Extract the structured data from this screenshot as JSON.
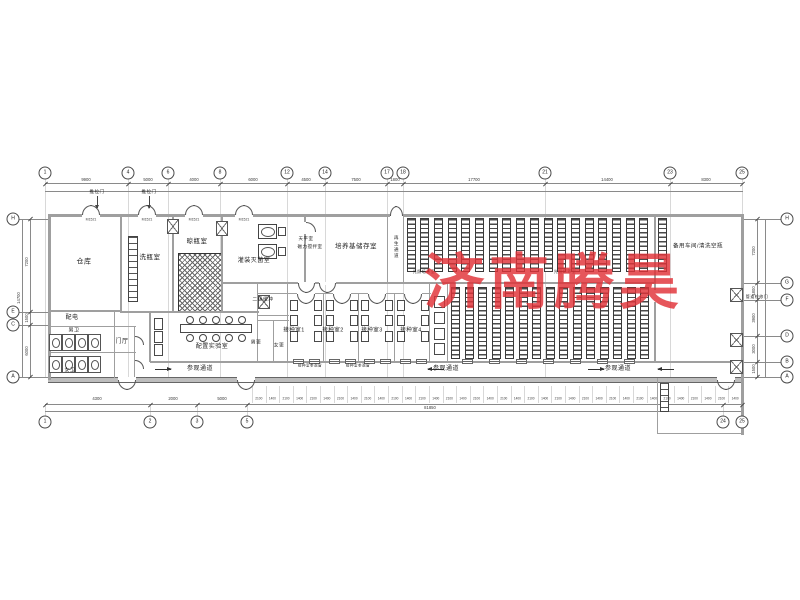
{
  "watermark": {
    "text": "济南腾昊",
    "color": "#e13238"
  },
  "plan": {
    "room_labels": [
      {
        "id": "warehouse",
        "label": "仓库",
        "x": 84,
        "y": 262,
        "fs": 7
      },
      {
        "id": "bottle-washing-room",
        "label": "洗瓶室",
        "x": 150,
        "y": 258,
        "fs": 6.5
      },
      {
        "id": "bottle-drying-room",
        "label": "晾瓶室",
        "x": 197,
        "y": 242,
        "fs": 6.5
      },
      {
        "id": "filling-sterilizing-room",
        "label": "灌装灭菌室",
        "x": 254,
        "y": 261,
        "fs": 6
      },
      {
        "id": "medium-storage-room",
        "label": "培养基储存室",
        "x": 356,
        "y": 247,
        "fs": 6.5
      },
      {
        "id": "regeneration-corridor",
        "label": "再生通道",
        "x": 396,
        "y": 247,
        "fs": 4.5,
        "vertical": true
      },
      {
        "id": "spare-workshop",
        "label": "备用车间/清洗空瓶",
        "x": 698,
        "y": 247,
        "fs": 5.5
      },
      {
        "id": "power-distribution",
        "label": "配电",
        "x": 72,
        "y": 318,
        "fs": 6
      },
      {
        "id": "toilet-male",
        "label": "男卫",
        "x": 74,
        "y": 331,
        "fs": 5
      },
      {
        "id": "toilet-female",
        "label": "女卫",
        "x": 70,
        "y": 371,
        "fs": 5
      },
      {
        "id": "entrance-hall",
        "label": "门厅",
        "x": 122,
        "y": 342,
        "fs": 6
      },
      {
        "id": "prep-laboratory",
        "label": "配置实验室",
        "x": 212,
        "y": 347,
        "fs": 6
      },
      {
        "id": "secondary-buffer",
        "label": "二级缓冲",
        "x": 263,
        "y": 301,
        "fs": 4.8
      },
      {
        "id": "changing-male",
        "label": "男更",
        "x": 256,
        "y": 344,
        "fs": 4.8
      },
      {
        "id": "changing-female",
        "label": "女更",
        "x": 279,
        "y": 347,
        "fs": 4.8
      },
      {
        "id": "inoculation-room-1",
        "label": "接种室1",
        "x": 294,
        "y": 331,
        "fs": 5.5
      },
      {
        "id": "inoculation-room-2",
        "label": "接种室2",
        "x": 333,
        "y": 331,
        "fs": 5.5
      },
      {
        "id": "inoculation-room-3",
        "label": "接种室3",
        "x": 372,
        "y": 331,
        "fs": 5.5
      },
      {
        "id": "inoculation-room-4",
        "label": "接种室4",
        "x": 411,
        "y": 331,
        "fs": 5.5
      },
      {
        "id": "visit-corridor-1",
        "label": "参观通道",
        "x": 200,
        "y": 369,
        "fs": 6
      },
      {
        "id": "visit-corridor-2",
        "label": "参观通道",
        "x": 446,
        "y": 369,
        "fs": 6
      },
      {
        "id": "visit-corridor-3",
        "label": "参观通道",
        "x": 618,
        "y": 369,
        "fs": 6
      },
      {
        "id": "light-culture-room-1",
        "label": "光照培养室",
        "x": 424,
        "y": 272,
        "fs": 4
      },
      {
        "id": "light-culture-room-2",
        "label": "光照培养室",
        "x": 565,
        "y": 272,
        "fs": 4
      },
      {
        "id": "sliding-door-note-1",
        "label": "推拉门",
        "x": 97,
        "y": 192,
        "fs": 4.5
      },
      {
        "id": "sliding-door-note-2",
        "label": "推拉门",
        "x": 149,
        "y": 192,
        "fs": 4.5
      },
      {
        "id": "balance-room-note",
        "label": "天平室",
        "x": 306,
        "y": 239,
        "fs": 4.5
      },
      {
        "id": "stirrer-room-note",
        "label": "磁力搅拌室",
        "x": 310,
        "y": 247,
        "fs": 4.5
      },
      {
        "id": "pipe-access-door-note",
        "label": "管道检修门",
        "x": 757,
        "y": 297,
        "fs": 4
      },
      {
        "id": "inoc-view-window-1",
        "label": "接种室参观窗",
        "x": 310,
        "y": 366,
        "fs": 3.5
      },
      {
        "id": "inoc-view-window-2",
        "label": "接种室参观窗",
        "x": 358,
        "y": 366,
        "fs": 3.5
      }
    ],
    "door_codes": [
      {
        "v": "M1521",
        "x": 91
      },
      {
        "v": "M1521",
        "x": 147
      },
      {
        "v": "M1521",
        "x": 194
      },
      {
        "v": "M1521",
        "x": 244
      }
    ]
  },
  "grid": {
    "top": [
      {
        "label": "1",
        "x": 45
      },
      {
        "label": "4",
        "x": 128
      },
      {
        "label": "6",
        "x": 168
      },
      {
        "label": "8",
        "x": 220
      },
      {
        "label": "12",
        "x": 287
      },
      {
        "label": "14",
        "x": 325
      },
      {
        "label": "17",
        "x": 387
      },
      {
        "label": "18",
        "x": 403
      },
      {
        "label": "21",
        "x": 545
      },
      {
        "label": "23",
        "x": 670
      },
      {
        "label": "25",
        "x": 742
      }
    ],
    "bottom": [
      {
        "label": "1",
        "x": 45
      },
      {
        "label": "2",
        "x": 150
      },
      {
        "label": "3",
        "x": 197
      },
      {
        "label": "5",
        "x": 247
      },
      {
        "label": "24",
        "x": 723
      },
      {
        "label": "25",
        "x": 742
      }
    ],
    "left": [
      {
        "label": "H",
        "y": 219
      },
      {
        "label": "E",
        "y": 312
      },
      {
        "label": "C",
        "y": 325
      },
      {
        "label": "A",
        "y": 377
      }
    ],
    "right": [
      {
        "label": "H",
        "y": 219
      },
      {
        "label": "G",
        "y": 283
      },
      {
        "label": "F",
        "y": 300
      },
      {
        "label": "D",
        "y": 336
      },
      {
        "label": "B",
        "y": 362
      },
      {
        "label": "A",
        "y": 377
      }
    ]
  },
  "dims": {
    "top": [
      {
        "v": "9900",
        "x": 86
      },
      {
        "v": "5000",
        "x": 148
      },
      {
        "v": "4000",
        "x": 194
      },
      {
        "v": "6000",
        "x": 253
      },
      {
        "v": "4500",
        "x": 306
      },
      {
        "v": "7500",
        "x": 356
      },
      {
        "v": "1800",
        "x": 395
      },
      {
        "v": "17700",
        "x": 474
      },
      {
        "v": "14400",
        "x": 607
      },
      {
        "v": "8300",
        "x": 706
      }
    ],
    "bottom_left": [
      {
        "v": "4300",
        "x": 97
      },
      {
        "v": "2000",
        "x": 173
      },
      {
        "v": "5000",
        "x": 222
      }
    ],
    "bottom_overall": "81850",
    "bottom_rack": [
      "2100",
      "1400",
      "2100",
      "1400",
      "2100",
      "1400",
      "2100",
      "1400",
      "2100",
      "1400",
      "2100",
      "1400",
      "2100",
      "1400",
      "2100",
      "1400",
      "2100",
      "1400",
      "2100",
      "1400",
      "2100",
      "1400",
      "2100",
      "1400",
      "2100",
      "1400",
      "2100",
      "1400",
      "2100",
      "1400",
      "2100",
      "1400",
      "2100",
      "1400",
      "2100",
      "1400"
    ],
    "left": [
      {
        "v": "7200",
        "y": 262
      },
      {
        "v": "1500",
        "y": 318
      },
      {
        "v": "6000",
        "y": 351
      }
    ],
    "left_total": "14700",
    "right": [
      {
        "v": "7200",
        "y": 251
      },
      {
        "v": "1800",
        "y": 291
      },
      {
        "v": "3900",
        "y": 318
      },
      {
        "v": "3000",
        "y": 349
      },
      {
        "v": "1500",
        "y": 369
      }
    ]
  }
}
